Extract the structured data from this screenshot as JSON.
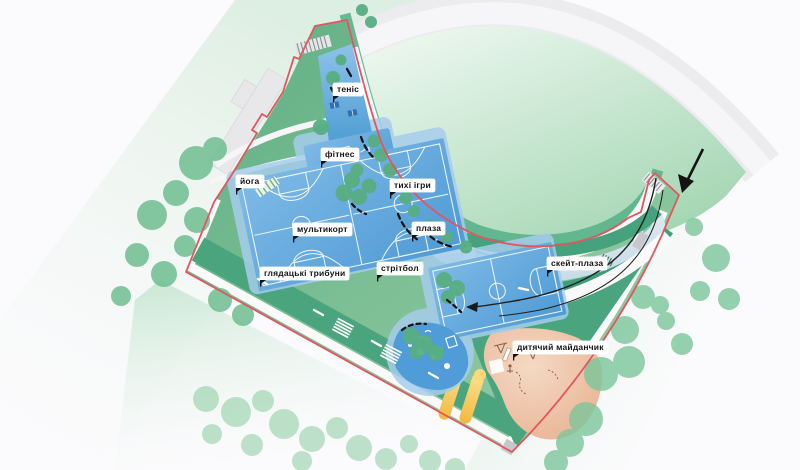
{
  "plan": {
    "type": "park-landscape-site-plan",
    "labels": [
      {
        "id": "tennis",
        "text": "теніс"
      },
      {
        "id": "fitness",
        "text": "фітнес"
      },
      {
        "id": "yoga",
        "text": "йога"
      },
      {
        "id": "quiet-games",
        "text": "тихі ігри"
      },
      {
        "id": "multicourt",
        "text": "мультикорт"
      },
      {
        "id": "plaza",
        "text": "плаза"
      },
      {
        "id": "skate-plaza",
        "text": "скейт-плаза"
      },
      {
        "id": "spectator-stands",
        "text": "глядацькі трибуни"
      },
      {
        "id": "streetball",
        "text": "стрітбол"
      },
      {
        "id": "playground",
        "text": "дитячий майданчик"
      }
    ],
    "icons": [
      {
        "name": "entry-arrow-icon",
        "meaning": "entrance direction into the site"
      },
      {
        "name": "route-arrow-icon",
        "meaning": "walking route direction"
      },
      {
        "name": "label-flag-icon",
        "meaning": "label anchor flag"
      }
    ],
    "colors": {
      "boundary_red": "#e2565f",
      "court_blue": "#5b9fd8",
      "lawn_green": "#79bd95",
      "terrace_dark_green": "#3f9e7a",
      "tree_green": "#7cc69b",
      "playground_salmon": "#ecbd9e",
      "slide_yellow": "#f5c547",
      "skate_plaza_gray_blue": "#dbe7ee",
      "path_white": "#fafafa",
      "background": "#fbfafc"
    }
  }
}
